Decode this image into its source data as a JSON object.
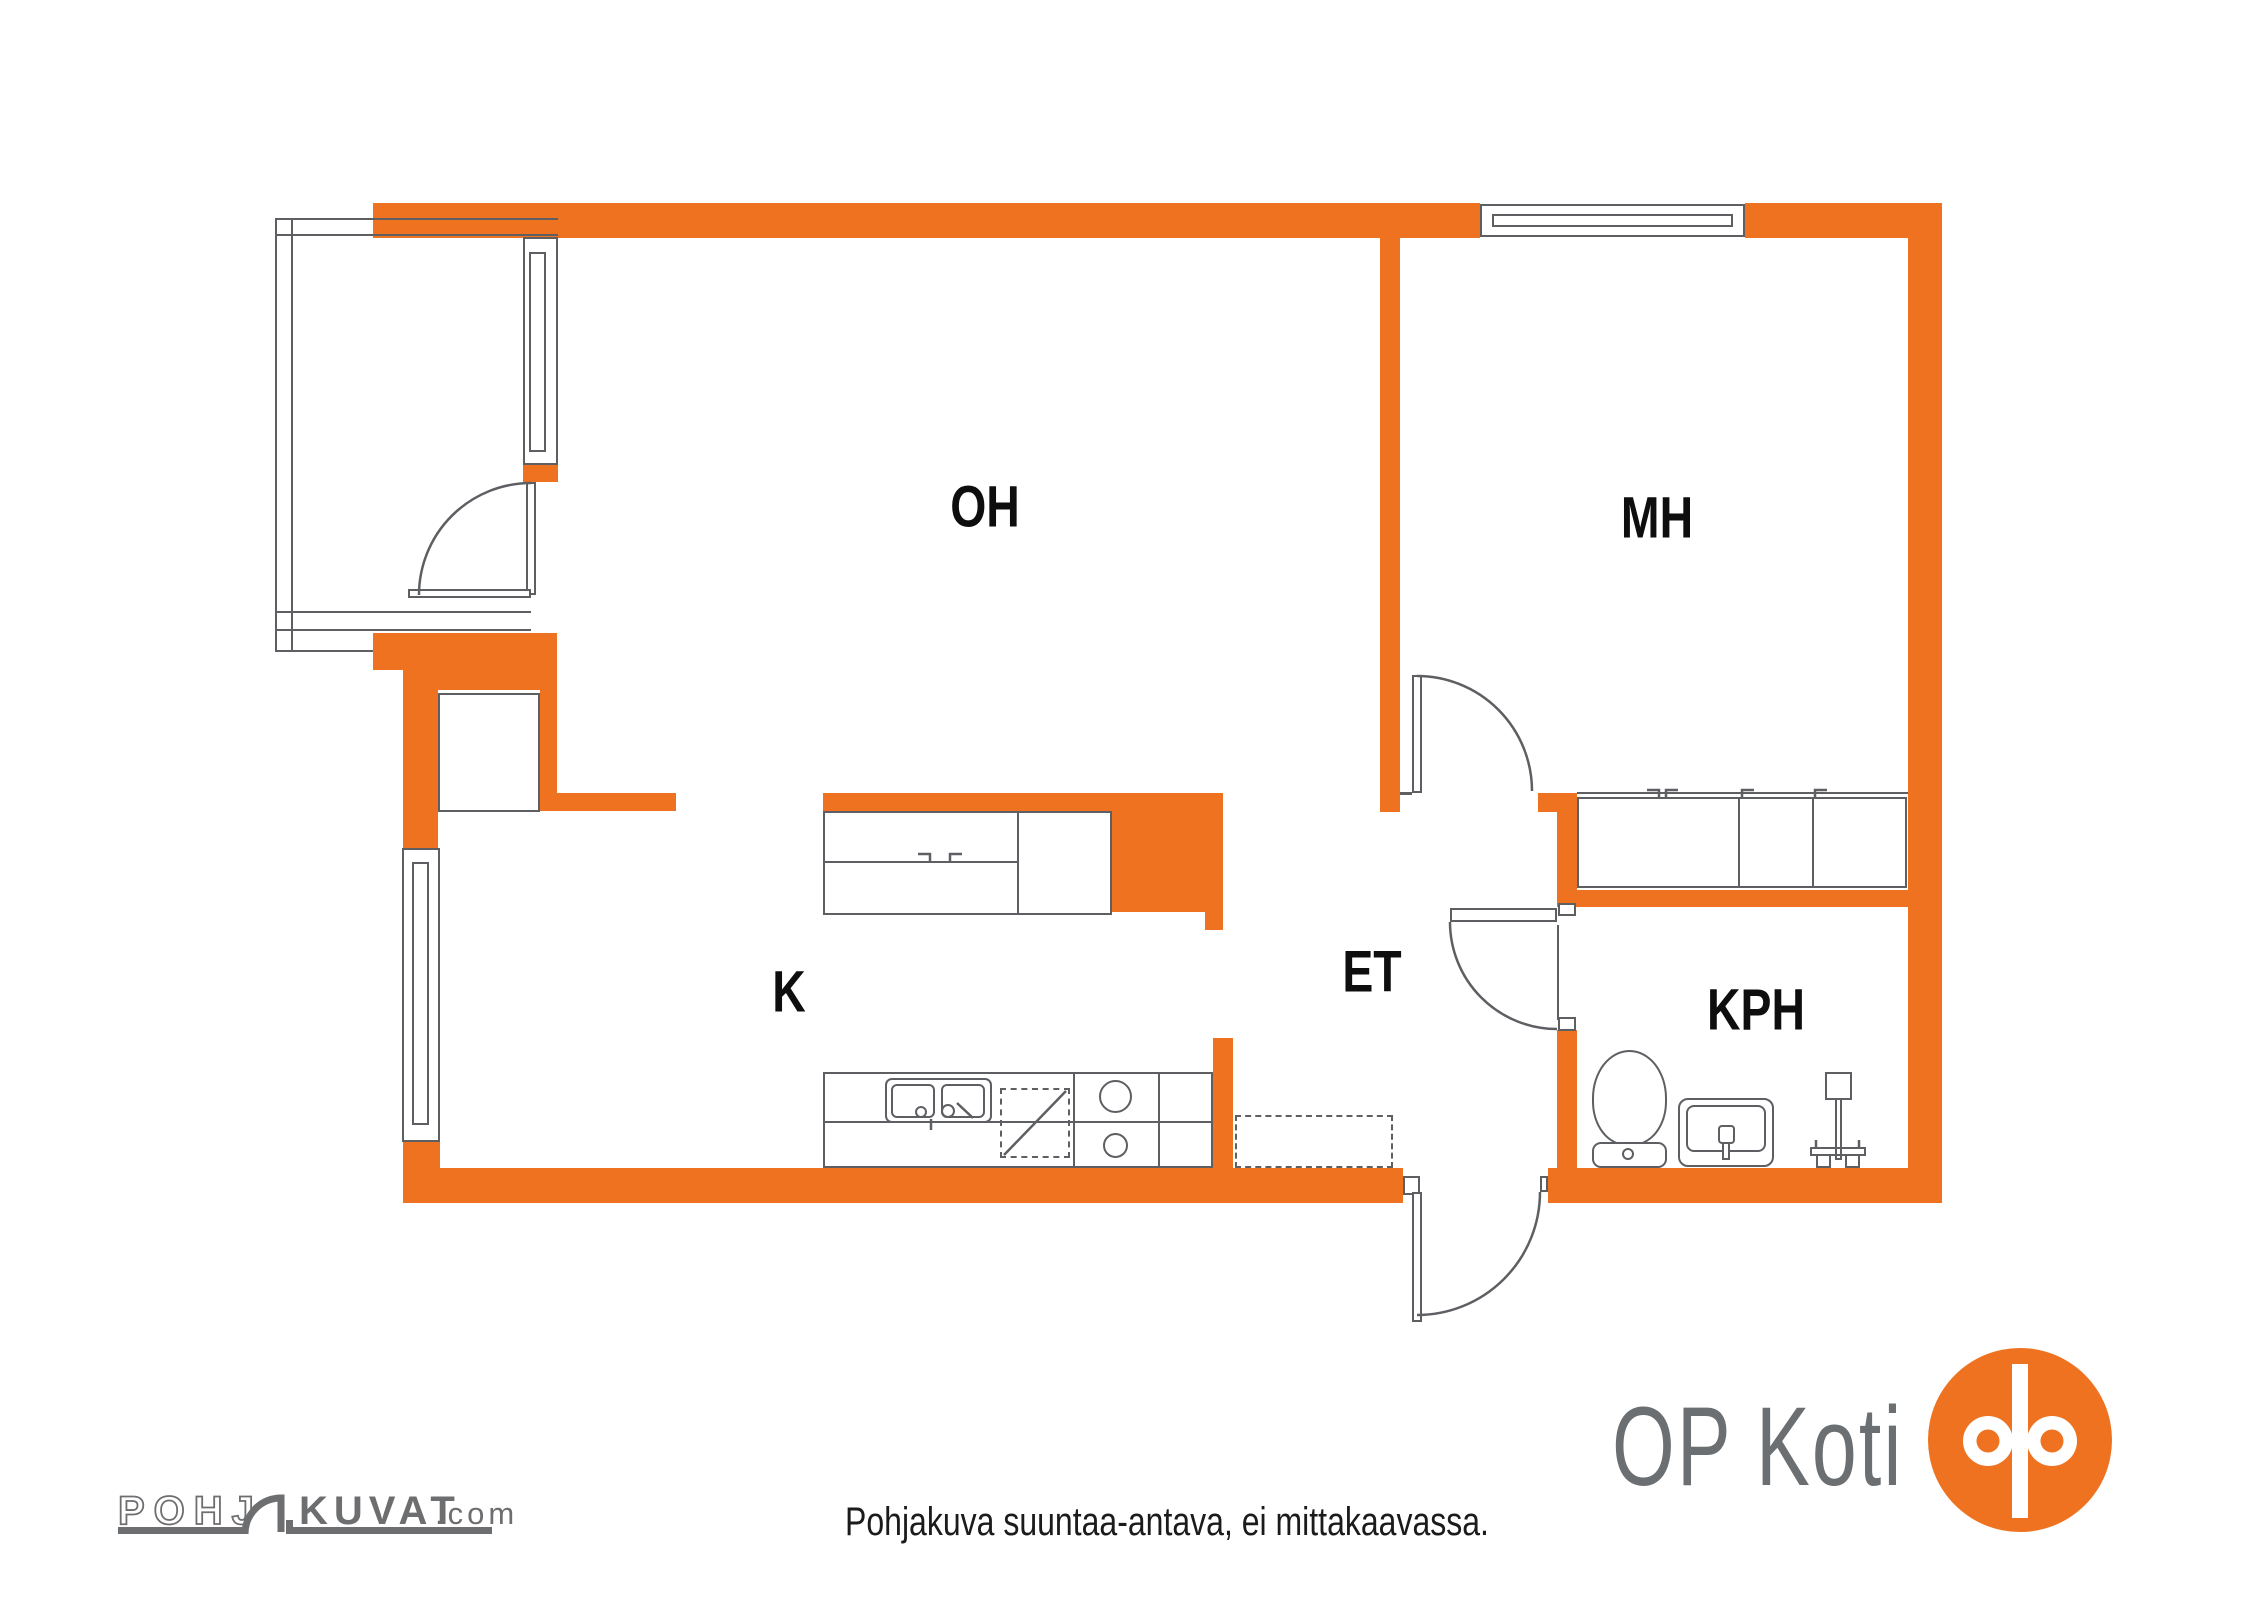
{
  "colors": {
    "orange": "#EE7220",
    "line": "#5d5f63",
    "logo_gray": "#6C6F72",
    "label": "#0e0e0e",
    "text": "#1b1b1b"
  },
  "rooms": {
    "living_room": "OH",
    "bedroom": "MH",
    "kitchen": "K",
    "entry_hall": "ET",
    "bathroom": "KPH"
  },
  "brand": {
    "name": "OP Koti"
  },
  "watermark": {
    "pohj": "POHJ",
    "kuvat": "KUVAT",
    "tld": ".com"
  },
  "footer": {
    "disclaimer": "Pohjakuva suuntaa-antava, ei mittakaavassa."
  },
  "fixtures": {
    "balcony": "balcony",
    "balcony_window": "window",
    "balcony_door": "door",
    "kitchen_window": "window",
    "bedroom_window": "window",
    "closet_nook": "closet",
    "kitchen_cabinet": "kitchen-cabinet",
    "kitchen_counter": "worktop",
    "sink": "double-sink",
    "dishwasher": "dishwasher-reservation",
    "stove": "stove",
    "hall_reservation": "appliance-reservation",
    "wardrobes": "sliding-door-wardrobes",
    "toilet": "toilet",
    "washbasin": "washbasin",
    "shower": "shower-mixer",
    "front_door": "entry-door",
    "bedroom_door": "door",
    "bathroom_door": "door"
  }
}
